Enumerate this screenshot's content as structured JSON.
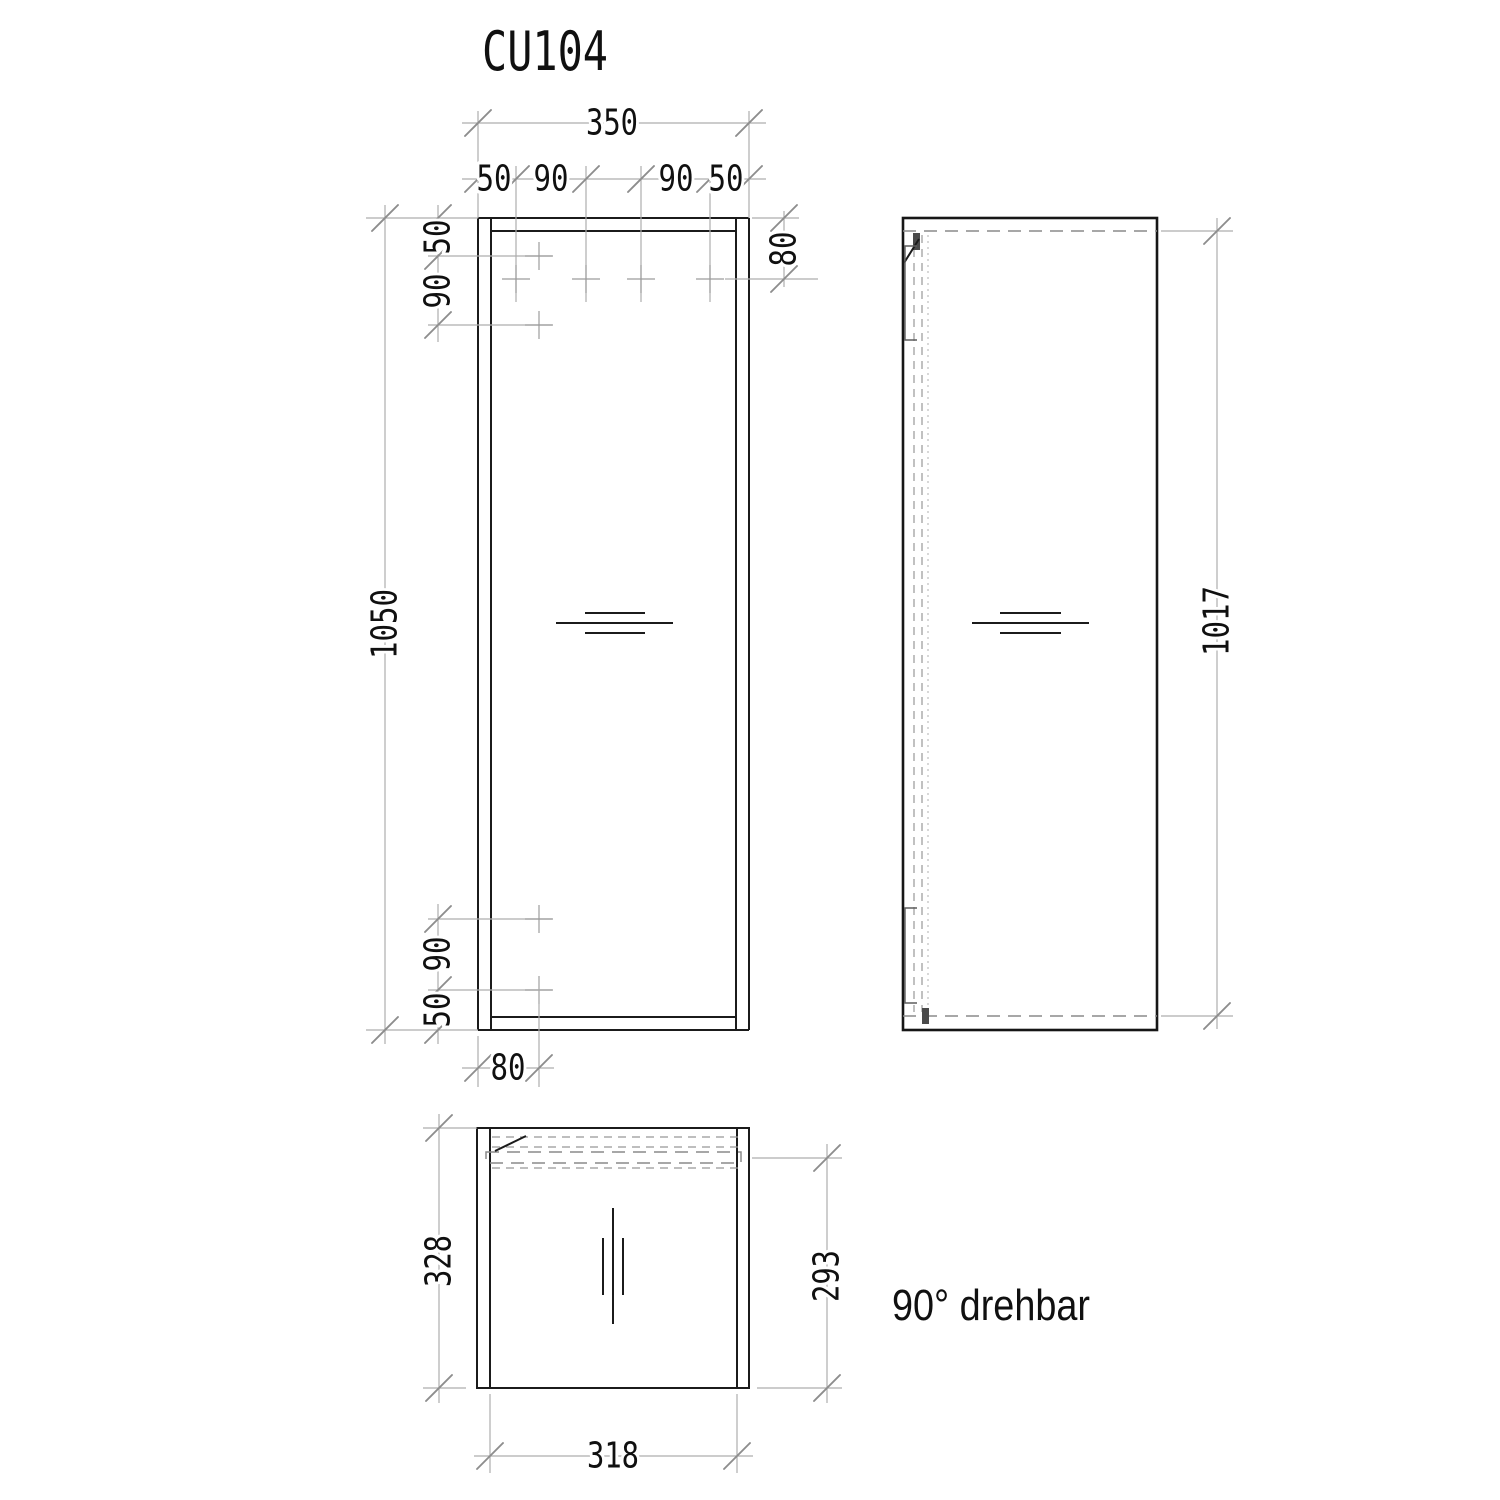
{
  "title": "CU104",
  "note": "90° drehbar",
  "colors": {
    "background": "#ffffff",
    "object_line": "#1b1b1b",
    "dimension_line": "#adadad",
    "hidden_line": "#8a8a8a",
    "text": "#101010"
  },
  "front_view": {
    "overall_width": "350",
    "overall_height": "1050",
    "top_hole_offsets": [
      "50",
      "90",
      "90",
      "50"
    ],
    "left_top_hole_offsets": [
      "50",
      "90"
    ],
    "left_bottom_hole_offsets": [
      "90",
      "50"
    ],
    "top_hole_row_offset": "80",
    "bottom_hole_col_offset": "80"
  },
  "side_view": {
    "door_height": "1017"
  },
  "top_view": {
    "overall_depth": "328",
    "door_swing_depth": "293",
    "inner_width": "318"
  }
}
